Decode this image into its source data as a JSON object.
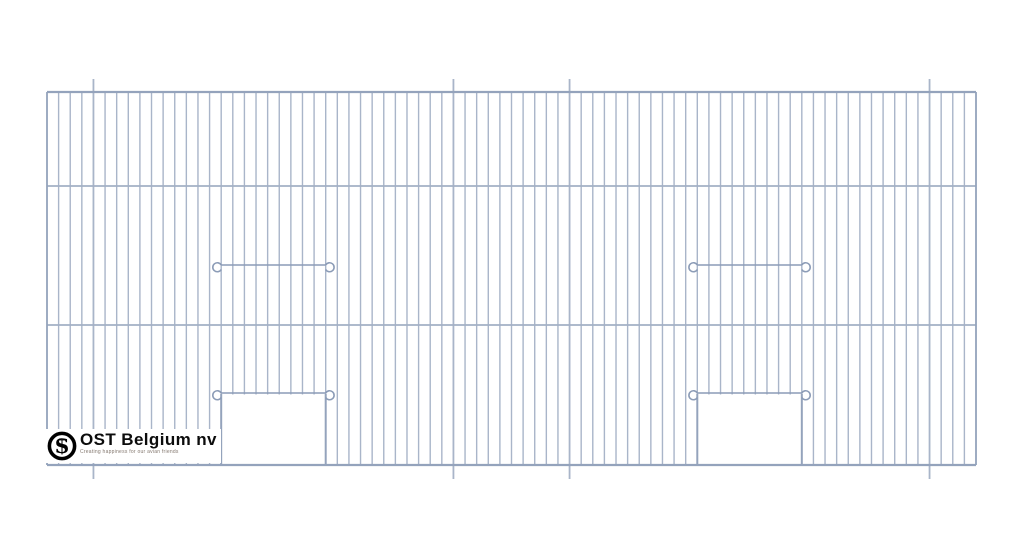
{
  "page": {
    "background": "#ffffff"
  },
  "logo": {
    "company": "OST Belgium nv",
    "tagline": "Creating happiness for our avian friends",
    "monogram_letter": "S",
    "text_color": "#0c0c0c",
    "tagline_color": "#84786f",
    "emblem_color": "#000000"
  },
  "drawing": {
    "description": "Wire mesh cage front panel, three rows, two doors with hooked latch bars",
    "colors": {
      "wire": "#a9b5c9",
      "mid_rail": "#a3b0c5",
      "frame": "#94a3bc",
      "bar": "#8c9cb7",
      "door_edge": "#94a3bc",
      "opening_fill": "#ffffff"
    },
    "panel": {
      "x": 47,
      "y": 92,
      "width": 929,
      "height": 373
    },
    "mid_rail_ys": [
      186,
      325
    ],
    "wire_intervals": 80,
    "wire_width": 1.4,
    "hanger_wire_indices": [
      4,
      35,
      45,
      76
    ],
    "hanger_tick_top": 13,
    "hanger_tick_bottom": 14,
    "doors": [
      {
        "start_interval": 15,
        "end_interval": 24
      },
      {
        "start_interval": 56,
        "end_interval": 65
      }
    ],
    "door_bar_y": 393,
    "middle_bar_y": 265,
    "bar_overhang": 9,
    "hook_radius": 4.5
  }
}
